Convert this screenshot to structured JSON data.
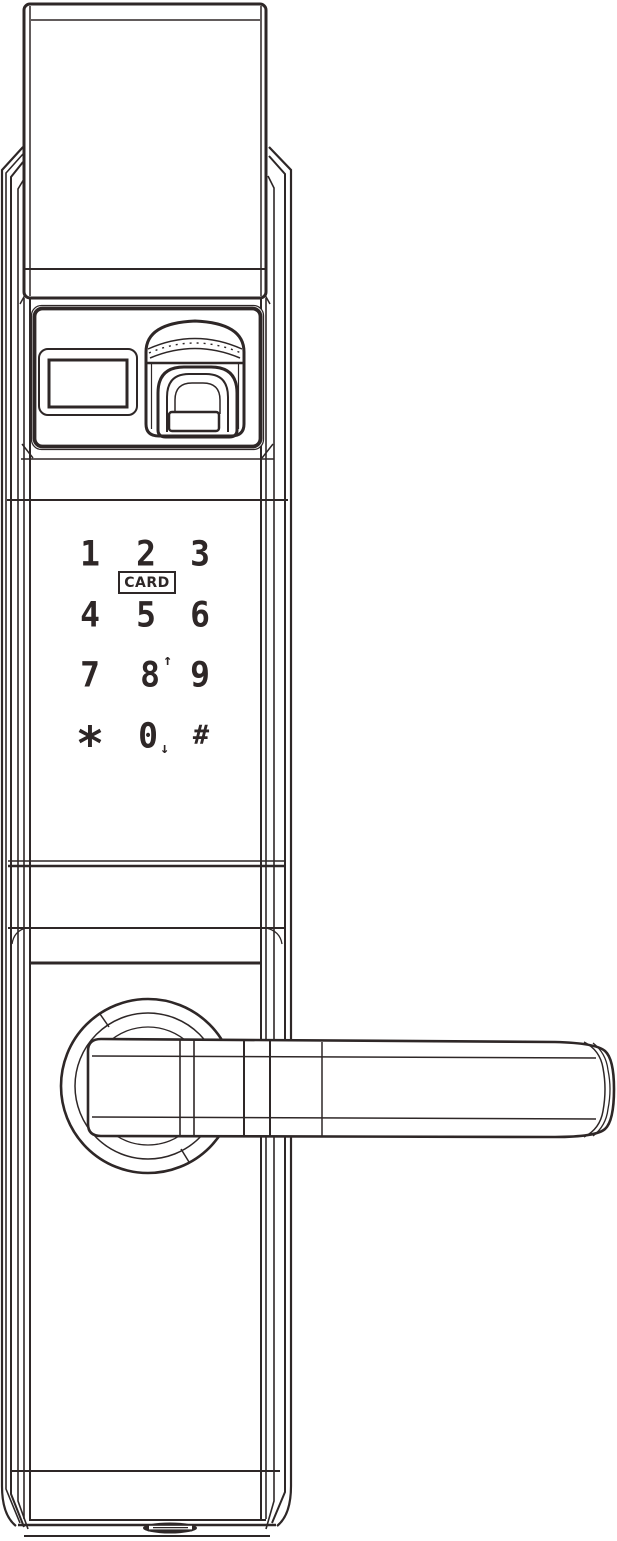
{
  "colors": {
    "ink": "#2e2727",
    "bg": "#ffffff"
  },
  "icons": {
    "fingerprint": "fingerprint-scanner-icon",
    "display": "status-display-window",
    "handle": "door-lever-handle",
    "port": "bottom-screw-port"
  },
  "card_reader": {
    "label": "CARD"
  },
  "keypad": {
    "keys": [
      {
        "label": "1"
      },
      {
        "label": "2"
      },
      {
        "label": "3"
      },
      {
        "label": "4"
      },
      {
        "label": "5"
      },
      {
        "label": "6"
      },
      {
        "label": "7"
      },
      {
        "label": "8",
        "suffix": "↑"
      },
      {
        "label": "9"
      },
      {
        "label": "*"
      },
      {
        "label": "0",
        "suffix": "↓"
      },
      {
        "label": "#"
      }
    ]
  }
}
